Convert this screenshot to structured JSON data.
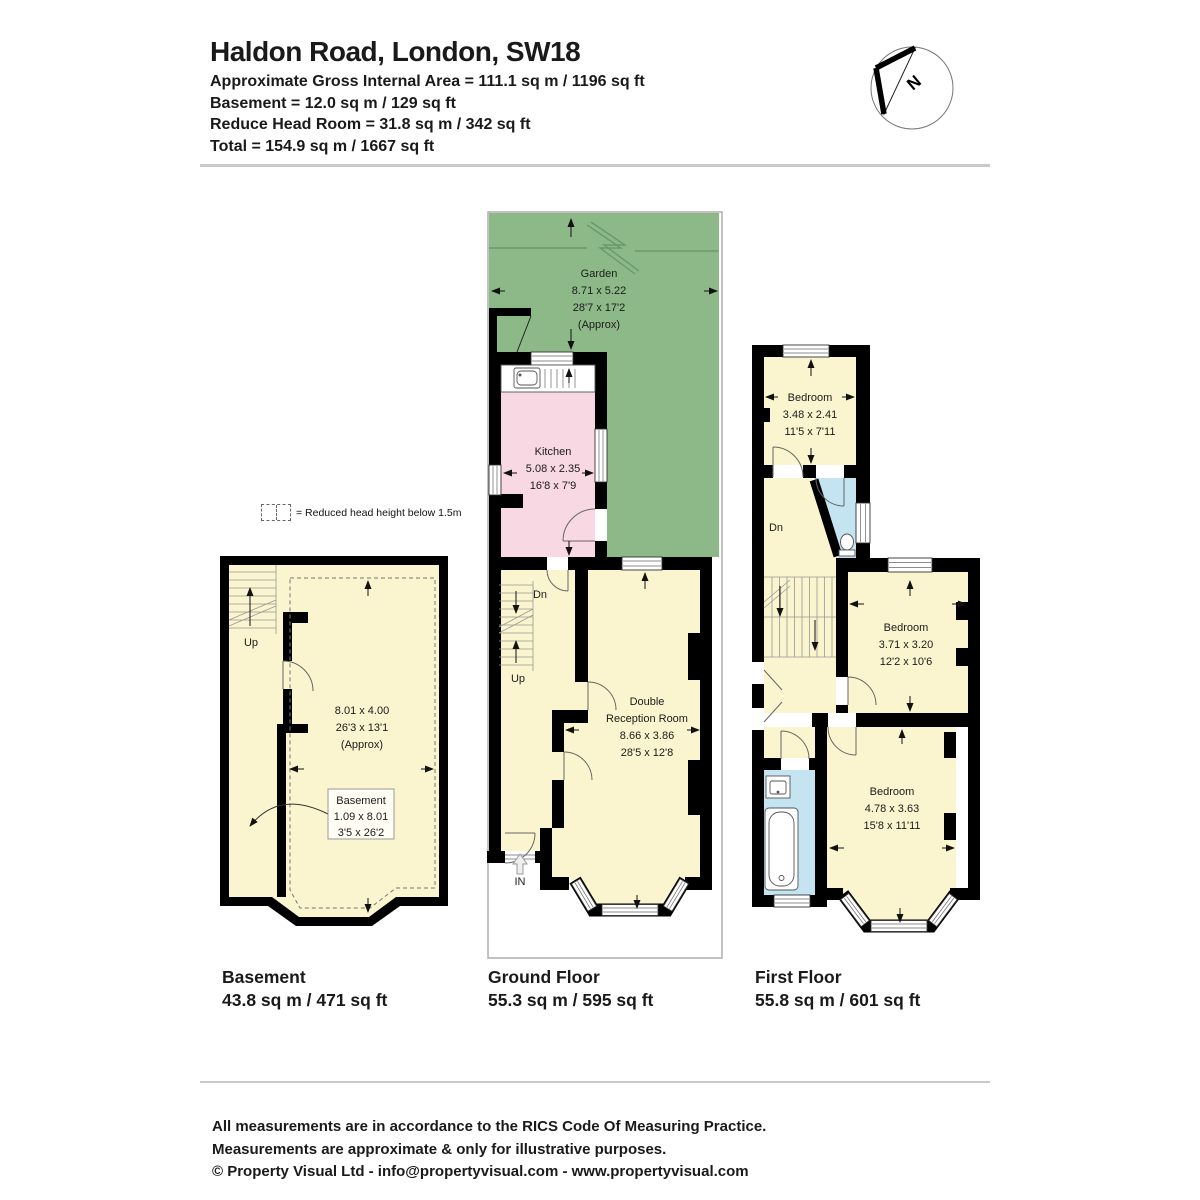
{
  "header": {
    "title": "Haldon Road, London, SW18",
    "area_line": "Approximate Gross Internal Area = 111.1 sq m / 1196 sq ft",
    "basement_line": "Basement = 12.0 sq m / 129 sq ft",
    "reduce_line": "Reduce Head Room = 31.8 sq m / 342 sq ft",
    "total_line": "Total = 154.9 sq m / 1667 sq ft"
  },
  "compass": {
    "north": "N"
  },
  "legend": {
    "text": "= Reduced head height below 1.5m"
  },
  "basement": {
    "floor_label": "Basement",
    "floor_area": "43.8 sq m / 471 sq ft",
    "stair_up": "Up",
    "dims_m": "8.01 x 4.00",
    "dims_ft": "26'3 x 13'1",
    "approx": "(Approx)",
    "callout": {
      "name": "Basement",
      "dims_m": "1.09 x 8.01",
      "dims_ft": "3'5 x 26'2"
    }
  },
  "ground": {
    "floor_label": "Ground Floor",
    "floor_area": "55.3 sq m / 595 sq ft",
    "garden": {
      "name": "Garden",
      "dims_m": "8.71 x 5.22",
      "dims_ft": "28'7 x 17'2",
      "approx": "(Approx)"
    },
    "kitchen": {
      "name": "Kitchen",
      "dims_m": "5.08 x 2.35",
      "dims_ft": "16'8 x 7'9"
    },
    "reception": {
      "name1": "Double",
      "name2": "Reception Room",
      "dims_m": "8.66 x 3.86",
      "dims_ft": "28'5 x 12'8"
    },
    "stair_dn": "Dn",
    "stair_up": "Up",
    "entrance": "IN"
  },
  "first": {
    "floor_label": "First Floor",
    "floor_area": "55.8 sq m / 601 sq ft",
    "stair_dn": "Dn",
    "bedroom1": {
      "name": "Bedroom",
      "dims_m": "3.48 x 2.41",
      "dims_ft": "11'5 x 7'11"
    },
    "bedroom2": {
      "name": "Bedroom",
      "dims_m": "3.71 x 3.20",
      "dims_ft": "12'2 x 10'6"
    },
    "bedroom3": {
      "name": "Bedroom",
      "dims_m": "4.78 x 3.63",
      "dims_ft": "15'8 x 11'11"
    }
  },
  "footer": {
    "line1": "All measurements are in accordance to the RICS Code Of Measuring Practice.",
    "line2": "Measurements are approximate & only for illustrative purposes.",
    "line3": "© Property Visual Ltd - info@propertyvisual.com - www.propertyvisual.com"
  },
  "colors": {
    "room_fill": "#FAF5CE",
    "kitchen_fill": "#F7D8E3",
    "garden_fill": "#8DB989",
    "bath_fill": "#C4E4F2",
    "wall": "#000000"
  }
}
